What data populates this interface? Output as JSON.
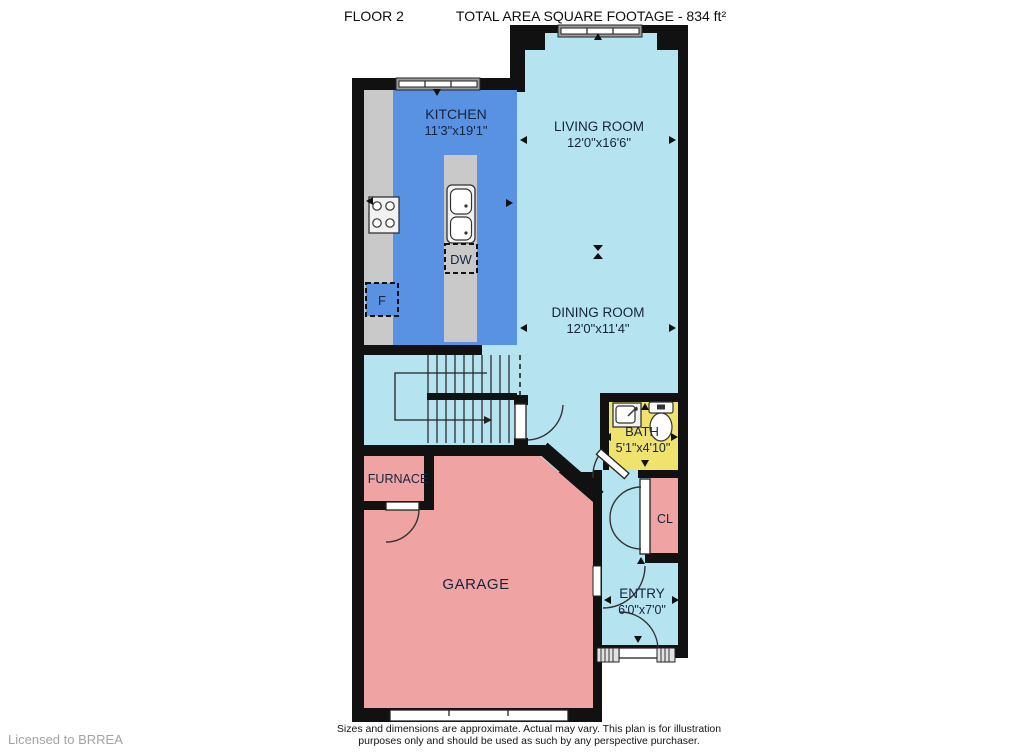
{
  "header": {
    "floor_label": "FLOOR 2",
    "area_label": "TOTAL AREA SQUARE FOOTAGE - 834 ft²"
  },
  "rooms": {
    "kitchen": {
      "name": "KITCHEN",
      "dims": "11'3\"x19'1\""
    },
    "living": {
      "name": "LIVING ROOM",
      "dims": "12'0\"x16'6\""
    },
    "dining": {
      "name": "DINING ROOM",
      "dims": "12'0\"x11'4\""
    },
    "bath": {
      "name": "BATH",
      "dims": "5'1\"x4'10\""
    },
    "closet": {
      "name": "CL"
    },
    "entry": {
      "name": "ENTRY",
      "dims": "6'0\"x7'0\""
    },
    "garage": {
      "name": "GARAGE"
    },
    "furnace": {
      "name": "FURNACE"
    }
  },
  "appliances": {
    "dishwasher": "DW",
    "fridge": "F"
  },
  "footer": {
    "license": "Licensed to BRREA",
    "disclaimer_line1": "Sizes and dimensions are approximate. Actual may vary. This plan is for illustration",
    "disclaimer_line2": "purposes only and should be used as such by any perspective purchaser."
  },
  "colors": {
    "wall": "#111111",
    "kitchen": "#5992e2",
    "room_light_blue": "#b5e3f0",
    "bath": "#efe36d",
    "garage_pink": "#f0a3a3",
    "counter": "#c9c9c9",
    "label": "#16243e",
    "license_gray": "#a3a3a3"
  }
}
